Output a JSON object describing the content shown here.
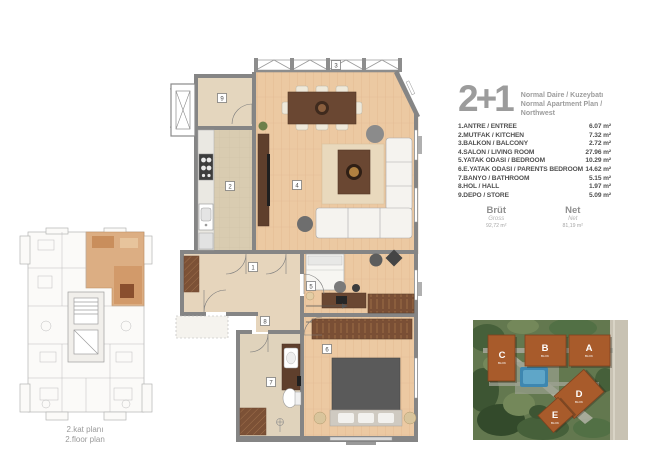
{
  "header": {
    "type": "2+1",
    "subtitle_tr": "Normal Daire / Kuzeybatı",
    "subtitle_en": "Normal Apartment Plan / Northwest"
  },
  "rooms": [
    {
      "label": "1.ANTRE / ENTREE",
      "area": "6.07 m²"
    },
    {
      "label": "2.MUTFAK / KITCHEN",
      "area": "7.32 m²"
    },
    {
      "label": "3.BALKON / BALCONY",
      "area": "2.72 m²"
    },
    {
      "label": "4.SALON / LIVING ROOM",
      "area": "27.96 m²"
    },
    {
      "label": "5.YATAK ODASI / BEDROOM",
      "area": "10.29 m²"
    },
    {
      "label": "6.E.YATAK ODASI / PARENTS BEDROOM",
      "area": "14.62 m²"
    },
    {
      "label": "7.BANYO / BATHROOM",
      "area": "5.15 m²"
    },
    {
      "label": "8.HOL / HALL",
      "area": "1.97 m²"
    },
    {
      "label": "9.DEPO / STORE",
      "area": "5.09 m²"
    }
  ],
  "totals": {
    "gross_title": "Brüt",
    "gross_sub": "Gross",
    "gross_value": "92,72 m²",
    "net_title": "Net",
    "net_sub": "Net",
    "net_value": "81,19 m²"
  },
  "key_plan": {
    "caption_tr": "2.kat planı",
    "caption_en": "2.floor plan"
  },
  "plan_labels": {
    "n1": "1",
    "n2": "2",
    "n3": "3",
    "n4": "4",
    "n5": "5",
    "n6": "6",
    "n7": "7",
    "n8": "8",
    "n9": "9"
  },
  "site": {
    "block_label": "BLOK",
    "buildings": [
      {
        "name": "C"
      },
      {
        "name": "B"
      },
      {
        "name": "A"
      },
      {
        "name": "D"
      },
      {
        "name": "E"
      }
    ]
  },
  "colors": {
    "wood_floor": "#ecc9a2",
    "tile_floor": "#d9ccb1",
    "entry_floor": "#e6d5bc",
    "wall": "#858585",
    "furniture_brown": "#6a4732",
    "highlight_unit": "#dcae83",
    "site_building": "#a85b2b",
    "text_gray": "#9c9c9c",
    "list_text": "#4f4f4f"
  }
}
